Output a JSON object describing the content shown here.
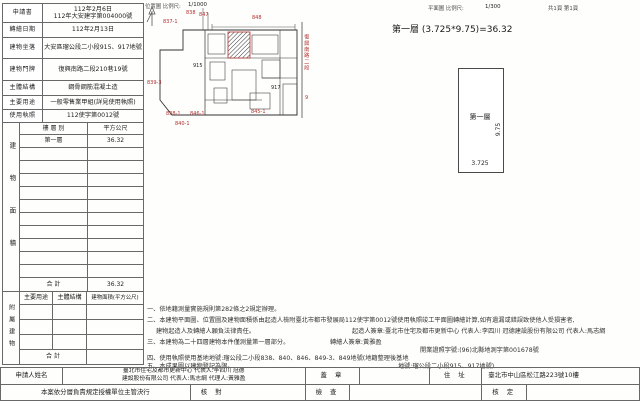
{
  "doc": {
    "plan_header": "平面圖 比例尺:",
    "plan_scale": "1/300",
    "pages": "共1頁 第1頁"
  },
  "header_form": {
    "rows": [
      {
        "label": "申請書",
        "value": "112年2月6日",
        "value2": "112年大安建字第004000號"
      },
      {
        "label": "轉繪日期",
        "value": "112年2月13日"
      },
      {
        "label": "建物坐落",
        "value": "大安區瑠公段二小段915、917地號"
      },
      {
        "label": "建物門牌",
        "value": "復興南路二段210巷19號"
      },
      {
        "label": "主體結構",
        "value": "鋼骨鋼筋混凝土造"
      },
      {
        "label": "主要用途",
        "value": "一般零售業甲組(詳見使用執照)"
      },
      {
        "label": "使用執照",
        "value": "112使字第0012號"
      }
    ]
  },
  "floor_table": {
    "side_label": "建物面積",
    "col_floor": "樓 層 別",
    "col_area": "平方公尺",
    "row_floor": "第一層",
    "row_area": "36.32",
    "total_label": "合 計",
    "total_value": "36.32"
  },
  "attached_table": {
    "side_label": "附屬建物",
    "col_use": "主要用途",
    "col_structure": "主體結構",
    "col_area": "建物面積(平方公尺)",
    "total_label": "合 計"
  },
  "site_plan": {
    "title": "位置圖 比例尺:",
    "scale": "1/1000",
    "street": "復興南路二段",
    "street_no": "9",
    "labels": [
      "838",
      "847",
      "848",
      "837-1",
      "839-3",
      "915",
      "917",
      "838-1",
      "846-1",
      "840-1",
      "845-1"
    ]
  },
  "floor_diagram": {
    "formula": "第一層 (3.725*9.75)=36.32",
    "room": "第一層",
    "height": "9.75",
    "width": "3.725"
  },
  "notes": {
    "segments": [
      "一、依地籍測量實施規則第282條之2規定辦理。",
      "二、本建物平面圖、位置圖及建物面積係由起造人檢附臺北市都市發展局112使字第0012號使用執照竣工平面圖轉繪計算,如有遺漏或錯誤致使他人受損害者,",
      "建物起造人及轉繪人願負法律責任。",
      "起造人簽章:臺北市住宅及都市更新中心 代表人:李四川  冠德建設股份有限公司 代表人:馬志綱",
      "三、本建物為二十四層建物本件僅測量第一層部分。",
      "轉繪人簽章:黃雅盈",
      "開業證照字號:(96)北縣地測字第001678號",
      "四、使用執照使用基地地號:瑠公段二小段838、840、846、849-3、849地號(地籍整理後基地",
      "五、本成果圖以建物登記為限。",
      "地號:瑠公段二小段915、917地號)"
    ]
  },
  "bottom_form": {
    "applicant_label": "申請人姓名",
    "applicant_line1": "臺北市住宅及都市更新中心 代表人:李四川  冠德",
    "applicant_line2": "建設股份有限公司 代表人:馬志綱  代理人:黃雅盈",
    "seal_label": "蓋 章",
    "address_label": "住 址",
    "address": "臺北市中山區松江路223號10樓",
    "approval_label": "本案依分層負責規定授權單位主管決行",
    "check_label": "核 對",
    "inspect_label": "檢 查",
    "approve_label": "核 定"
  }
}
